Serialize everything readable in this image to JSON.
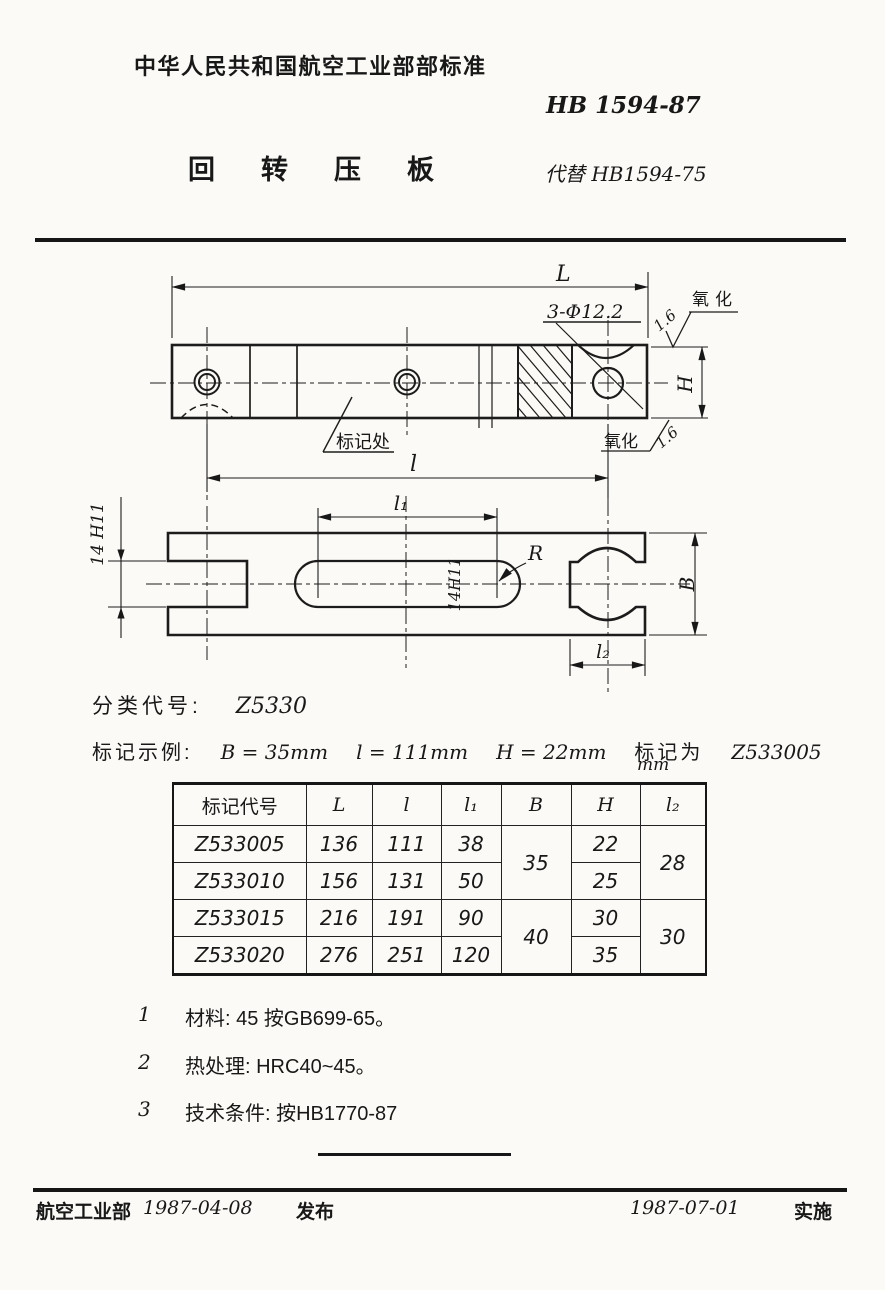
{
  "header": {
    "org": "中华人民共和国航空工业部部标准",
    "std_no": "HB 1594-87",
    "title": "回转压板",
    "replaces": "代替 HB1594-75"
  },
  "drawing": {
    "front": {
      "dim_L": "L",
      "dim_l": "l",
      "dim_H": "H",
      "holes_label": "3-Φ12.2",
      "finish_top": "1.6",
      "finish_top_note": "氧化",
      "finish_bottom": "1.6",
      "finish_bottom_note": "氧化",
      "marking_label": "标记处"
    },
    "plan": {
      "dim_l1": "l₁",
      "dim_l2": "l₂",
      "dim_B": "B",
      "radius_label": "R",
      "slot_tol": "14H11",
      "fork_tol": "14 H11"
    }
  },
  "classification": {
    "label": "分类代号:",
    "value": "Z5330"
  },
  "marking_example": {
    "label": "标记示例:",
    "b": "B = 35mm",
    "l": "l = 111mm",
    "h": "H = 22mm",
    "mark_as": "标记为",
    "code": "Z533005"
  },
  "table": {
    "unit": "mm",
    "headers": {
      "code": "标记代号",
      "L": "L",
      "l": "l",
      "l1": "l₁",
      "B": "B",
      "H": "H",
      "l2": "l₂"
    },
    "rows": [
      {
        "code": "Z533005",
        "L": "136",
        "l": "111",
        "l1": "38",
        "H": "22"
      },
      {
        "code": "Z533010",
        "L": "156",
        "l": "131",
        "l1": "50",
        "H": "25"
      },
      {
        "code": "Z533015",
        "L": "216",
        "l": "191",
        "l1": "90",
        "H": "30"
      },
      {
        "code": "Z533020",
        "L": "276",
        "l": "251",
        "l1": "120",
        "H": "35"
      }
    ],
    "B_group1": "35",
    "B_group2": "40",
    "l2_group1": "28",
    "l2_group2": "30"
  },
  "notes": [
    {
      "num": "1",
      "text": "材料: 45 按GB699-65。"
    },
    {
      "num": "2",
      "text": "热处理: HRC40~45。"
    },
    {
      "num": "3",
      "text": "技术条件: 按HB1770-87"
    }
  ],
  "footer": {
    "org": "航空工业部",
    "release_date": "1987-04-08",
    "release": "发布",
    "impl_date": "1987-07-01",
    "impl": "实施"
  }
}
